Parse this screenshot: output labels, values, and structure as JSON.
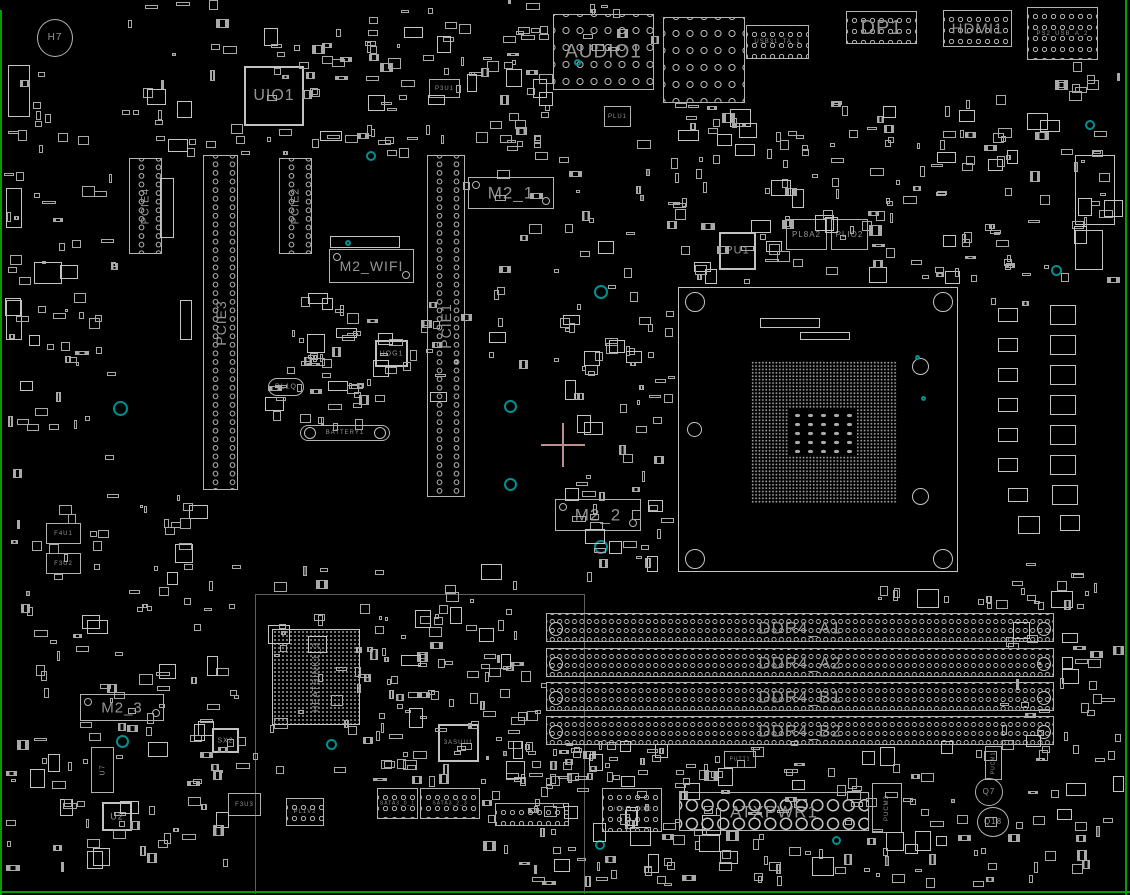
{
  "app": {
    "title": "Motherboard board view",
    "background": "#000000",
    "outline_color": "#b4b4b4",
    "label_color": "#949494",
    "board_edge_color": "#00a000",
    "teal_color": "#009090",
    "crosshair": {
      "x": 563,
      "y": 445,
      "arm": 22,
      "color": "#bc8f8f"
    }
  },
  "components": [
    {
      "id": "audio1",
      "label": "AUDIO1",
      "x": 553,
      "y": 14,
      "w": 101,
      "h": 76,
      "type": "conn-rings",
      "fs": 19,
      "v": 0
    },
    {
      "id": "usb-lan-stack",
      "label": "",
      "x": 663,
      "y": 17,
      "w": 82,
      "h": 86,
      "type": "conn-rings",
      "fs": 0,
      "v": 0
    },
    {
      "id": "usb31_ta_1",
      "label": "USB31_TA_1",
      "x": 746,
      "y": 25,
      "w": 63,
      "h": 34,
      "type": "conn-rings-sm",
      "fs": 6,
      "v": 0
    },
    {
      "id": "dp1",
      "label": "DP1",
      "x": 846,
      "y": 11,
      "w": 71,
      "h": 33,
      "type": "conn-rings-sm",
      "fs": 20,
      "v": 0
    },
    {
      "id": "hdmi1",
      "label": "HDMI1",
      "x": 943,
      "y": 10,
      "w": 69,
      "h": 37,
      "type": "conn-rings-sm",
      "fs": 15,
      "v": 0
    },
    {
      "id": "ps2_usb_a_2",
      "label": "PS2_USB_A_2",
      "x": 1027,
      "y": 7,
      "w": 71,
      "h": 53,
      "type": "conn-rings-sm",
      "fs": 6,
      "v": 0
    },
    {
      "id": "uio1",
      "label": "UIO1",
      "x": 244,
      "y": 66,
      "w": 60,
      "h": 60,
      "type": "chip",
      "fs": 16,
      "v": 0
    },
    {
      "id": "pcie4",
      "label": "PCIE4",
      "x": 129,
      "y": 158,
      "w": 33,
      "h": 96,
      "type": "slot-v",
      "fs": 11,
      "v": 1
    },
    {
      "id": "pcie2",
      "label": "PCIE2",
      "x": 279,
      "y": 158,
      "w": 33,
      "h": 96,
      "type": "slot-v",
      "fs": 11,
      "v": 1
    },
    {
      "id": "pcie3",
      "label": "PCIE3",
      "x": 203,
      "y": 155,
      "w": 35,
      "h": 335,
      "type": "slot-v",
      "fs": 14,
      "v": 1
    },
    {
      "id": "pcie1",
      "label": "PCIE1",
      "x": 427,
      "y": 155,
      "w": 38,
      "h": 342,
      "type": "slot-v",
      "fs": 14,
      "v": 1
    },
    {
      "id": "m2_1",
      "label": "M2_1",
      "x": 468,
      "y": 177,
      "w": 86,
      "h": 32,
      "type": "conn",
      "fs": 17,
      "v": 0
    },
    {
      "id": "m2_wifi",
      "label": "M2_WIFI",
      "x": 329,
      "y": 249,
      "w": 85,
      "h": 34,
      "type": "conn",
      "fs": 14,
      "v": 0
    },
    {
      "id": "m2_2",
      "label": "M2_2",
      "x": 555,
      "y": 499,
      "w": 86,
      "h": 32,
      "type": "conn",
      "fs": 17,
      "v": 0
    },
    {
      "id": "m2_3",
      "label": "M2_3",
      "x": 80,
      "y": 694,
      "w": 84,
      "h": 27,
      "type": "conn",
      "fs": 15,
      "v": 0
    },
    {
      "id": "pu1",
      "label": "PU1",
      "x": 719,
      "y": 232,
      "w": 37,
      "h": 38,
      "type": "chip",
      "fs": 11,
      "v": 0
    },
    {
      "id": "pl8a2",
      "label": "PL8A2",
      "x": 786,
      "y": 219,
      "w": 41,
      "h": 31,
      "type": "box",
      "fs": 8,
      "v": 0
    },
    {
      "id": "plio2",
      "label": "PLIO2",
      "x": 831,
      "y": 219,
      "w": 37,
      "h": 31,
      "type": "box",
      "fs": 8,
      "v": 0
    },
    {
      "id": "plu1",
      "label": "PLU1",
      "x": 604,
      "y": 106,
      "w": 27,
      "h": 21,
      "type": "box",
      "fs": 6,
      "v": 0
    },
    {
      "id": "p3u1",
      "label": "P3U1",
      "x": 429,
      "y": 79,
      "w": 31,
      "h": 19,
      "type": "box",
      "fs": 6,
      "v": 0
    },
    {
      "id": "uog1",
      "label": "UOG1",
      "x": 375,
      "y": 340,
      "w": 33,
      "h": 27,
      "type": "chip",
      "fs": 7,
      "v": 0
    },
    {
      "id": "pl1q",
      "label": "PL1Q",
      "x": 268,
      "y": 378,
      "w": 36,
      "h": 18,
      "type": "pill",
      "fs": 7,
      "v": 0
    },
    {
      "id": "battery1",
      "label": "BATTERY1",
      "x": 300,
      "y": 425,
      "w": 90,
      "h": 16,
      "type": "battery",
      "fs": 6,
      "v": 0
    },
    {
      "id": "heatsink1_3",
      "label": "HEATSINK1_3",
      "x": 272,
      "y": 629,
      "w": 88,
      "h": 96,
      "type": "bga",
      "fs": 9,
      "v": 1
    },
    {
      "id": "sx2",
      "label": "SX2",
      "x": 212,
      "y": 728,
      "w": 27,
      "h": 25,
      "type": "chip",
      "fs": 7,
      "v": 0
    },
    {
      "id": "u_3asuu1",
      "label": "3ASUU1",
      "x": 438,
      "y": 724,
      "w": 41,
      "h": 38,
      "type": "chip",
      "fs": 6,
      "v": 0
    },
    {
      "id": "ddr4_a1",
      "label": "DDR4_A1",
      "x": 546,
      "y": 613,
      "w": 508,
      "h": 29,
      "type": "dimm",
      "fs": 17,
      "v": 0
    },
    {
      "id": "ddr4_a2",
      "label": "DDR4_A2",
      "x": 546,
      "y": 648,
      "w": 508,
      "h": 29,
      "type": "dimm",
      "fs": 17,
      "v": 0
    },
    {
      "id": "ddr4_b1",
      "label": "DDR4_B1",
      "x": 546,
      "y": 682,
      "w": 508,
      "h": 29,
      "type": "dimm",
      "fs": 17,
      "v": 0
    },
    {
      "id": "ddr4_b2",
      "label": "DDR4_B2",
      "x": 546,
      "y": 716,
      "w": 508,
      "h": 29,
      "type": "dimm",
      "fs": 17,
      "v": 0
    },
    {
      "id": "atxpwr1",
      "label": "ATXPWR1",
      "x": 679,
      "y": 792,
      "w": 190,
      "h": 39,
      "type": "atx",
      "fs": 17,
      "v": 0
    },
    {
      "id": "usb31_tc_2",
      "label": "USB31_TC_2",
      "x": 602,
      "y": 788,
      "w": 60,
      "h": 44,
      "type": "conn-rings-sm",
      "fs": 5,
      "v": 0
    },
    {
      "id": "sata3_0_1",
      "label": "SATA3_0_1",
      "x": 377,
      "y": 788,
      "w": 41,
      "h": 31,
      "type": "conn-rings-sm",
      "fs": 5,
      "v": 0
    },
    {
      "id": "sata3_2_3",
      "label": "SATA3_2_3",
      "x": 420,
      "y": 788,
      "w": 60,
      "h": 31,
      "type": "conn-rings-sm",
      "fs": 5,
      "v": 0
    },
    {
      "id": "panel-header",
      "label": "",
      "x": 495,
      "y": 803,
      "w": 74,
      "h": 23,
      "type": "conn-rings-sm",
      "fs": 0,
      "v": 0
    },
    {
      "id": "pl1v2",
      "label": "PL1V2",
      "x": 286,
      "y": 798,
      "w": 38,
      "h": 28,
      "type": "conn-rings-sm",
      "fs": 6,
      "v": 0
    },
    {
      "id": "f3u3",
      "label": "F3U3",
      "x": 228,
      "y": 793,
      "w": 33,
      "h": 23,
      "type": "box",
      "fs": 6,
      "v": 0
    },
    {
      "id": "u2",
      "label": "U2",
      "x": 102,
      "y": 802,
      "w": 30,
      "h": 29,
      "type": "chip",
      "fs": 9,
      "v": 0
    },
    {
      "id": "f4u1",
      "label": "F4U1",
      "x": 46,
      "y": 523,
      "w": 35,
      "h": 21,
      "type": "box",
      "fs": 6,
      "v": 0
    },
    {
      "id": "f3u2",
      "label": "F3U2",
      "x": 46,
      "y": 553,
      "w": 35,
      "h": 21,
      "type": "box",
      "fs": 6,
      "v": 0
    },
    {
      "id": "pucm3",
      "label": "PUCM3",
      "x": 872,
      "y": 783,
      "w": 30,
      "h": 50,
      "type": "box",
      "fs": 6,
      "v": 1
    },
    {
      "id": "pucm1",
      "label": "PUCM1",
      "x": 985,
      "y": 746,
      "w": 17,
      "h": 34,
      "type": "box",
      "fs": 5,
      "v": 1
    },
    {
      "id": "q7",
      "label": "Q7",
      "x": 975,
      "y": 778,
      "w": 28,
      "h": 28,
      "type": "circle",
      "fs": 8,
      "v": 0
    },
    {
      "id": "q18",
      "label": "Q18",
      "x": 977,
      "y": 807,
      "w": 32,
      "h": 30,
      "type": "circle",
      "fs": 8,
      "v": 0
    },
    {
      "id": "h7",
      "label": "H7",
      "x": 37,
      "y": 19,
      "w": 36,
      "h": 38,
      "type": "circle",
      "fs": 10,
      "v": 0
    },
    {
      "id": "u7",
      "label": "U7",
      "x": 91,
      "y": 747,
      "w": 23,
      "h": 46,
      "type": "box",
      "fs": 7,
      "v": 1
    },
    {
      "id": "putt1",
      "label": "PUTT1",
      "x": 724,
      "y": 751,
      "w": 32,
      "h": 17,
      "type": "box",
      "fs": 5,
      "v": 0
    }
  ],
  "fixed_parts": [
    [
      998,
      308,
      20,
      14
    ],
    [
      1050,
      305,
      26,
      20
    ],
    [
      998,
      338,
      20,
      14
    ],
    [
      1050,
      335,
      26,
      20
    ],
    [
      998,
      368,
      20,
      14
    ],
    [
      1050,
      365,
      26,
      20
    ],
    [
      998,
      398,
      20,
      14
    ],
    [
      1050,
      395,
      26,
      20
    ],
    [
      998,
      428,
      20,
      14
    ],
    [
      1050,
      425,
      26,
      20
    ],
    [
      998,
      458,
      20,
      14
    ],
    [
      1050,
      455,
      26,
      20
    ],
    [
      1008,
      488,
      20,
      14
    ],
    [
      1052,
      485,
      26,
      20
    ],
    [
      1018,
      516,
      22,
      18
    ],
    [
      1060,
      515,
      20,
      16
    ],
    [
      1075,
      155,
      40,
      70
    ],
    [
      1075,
      230,
      28,
      40
    ],
    [
      8,
      65,
      22,
      52
    ],
    [
      6,
      188,
      16,
      40
    ],
    [
      6,
      300,
      16,
      40
    ],
    [
      34,
      262,
      28,
      22
    ],
    [
      60,
      265,
      18,
      14
    ],
    [
      330,
      236,
      70,
      12
    ],
    [
      760,
      318,
      60,
      10
    ],
    [
      800,
      332,
      50,
      8
    ],
    [
      160,
      178,
      14,
      60
    ],
    [
      180,
      300,
      12,
      40
    ]
  ],
  "teal_markers": [
    [
      371,
      156,
      10
    ],
    [
      601,
      292,
      14
    ],
    [
      601,
      547,
      14
    ],
    [
      510,
      406,
      13
    ],
    [
      510,
      484,
      13
    ],
    [
      120,
      408,
      15
    ],
    [
      1056,
      270,
      11
    ],
    [
      122,
      741,
      13
    ],
    [
      331,
      744,
      11
    ],
    [
      836,
      840,
      9
    ],
    [
      1090,
      125,
      10
    ],
    [
      348,
      243,
      6
    ],
    [
      577,
      62,
      7
    ],
    [
      917,
      357,
      5
    ],
    [
      923,
      398,
      5
    ],
    [
      600,
      845,
      10
    ]
  ],
  "clutter_regions": [
    [
      0,
      60,
      120,
      420,
      60
    ],
    [
      120,
      0,
      430,
      160,
      110
    ],
    [
      455,
      60,
      200,
      340,
      60
    ],
    [
      660,
      100,
      320,
      185,
      120
    ],
    [
      980,
      60,
      145,
      250,
      55
    ],
    [
      560,
      300,
      115,
      290,
      55
    ],
    [
      0,
      490,
      250,
      395,
      130
    ],
    [
      250,
      560,
      300,
      230,
      80
    ],
    [
      360,
      600,
      185,
      185,
      50
    ],
    [
      480,
      740,
      195,
      150,
      60
    ],
    [
      660,
      740,
      340,
      148,
      100
    ],
    [
      1000,
      560,
      125,
      325,
      60
    ],
    [
      545,
      745,
      120,
      48,
      22
    ],
    [
      300,
      290,
      160,
      115,
      35
    ],
    [
      260,
      330,
      160,
      108,
      30
    ],
    [
      875,
      585,
      220,
      25,
      18
    ],
    [
      560,
      0,
      100,
      55,
      10
    ]
  ],
  "socket": {
    "x": 678,
    "y": 287,
    "w": 280,
    "h": 285,
    "field": {
      "x": 72,
      "y": 73,
      "w": 146,
      "h": 142
    },
    "cavity": {
      "x": 38,
      "y": 48,
      "w": 68,
      "h": 46
    },
    "caps": {
      "x": 2,
      "y": 2,
      "w": 64,
      "h": 42
    },
    "holes": [
      [
        6,
        4,
        20
      ],
      [
        254,
        4,
        20
      ],
      [
        6,
        261,
        20
      ],
      [
        254,
        261,
        20
      ],
      [
        233,
        70,
        17
      ],
      [
        233,
        200,
        17
      ],
      [
        8,
        134,
        15
      ]
    ]
  },
  "chipset_region": {
    "x": 255,
    "y": 594,
    "w": 330,
    "h": 300
  }
}
